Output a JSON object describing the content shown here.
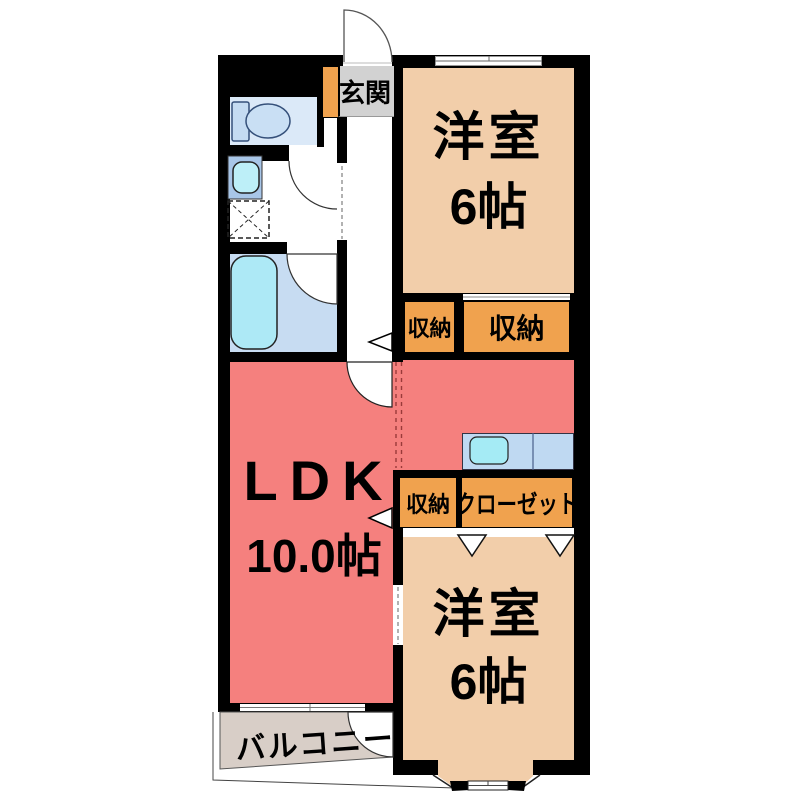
{
  "plan": {
    "entrance": {
      "label": "玄関"
    },
    "western_room_top": {
      "name": "洋室",
      "size": "6帖"
    },
    "western_room_bottom": {
      "name": "洋室",
      "size": "6帖"
    },
    "ldk": {
      "name": "LDK",
      "size": "10.0帖"
    },
    "storage_top_small": {
      "label": "収納"
    },
    "storage_top_large": {
      "label": "収納"
    },
    "storage_mid": {
      "label": "収納"
    },
    "closet": {
      "label": "クローゼット"
    },
    "balcony": {
      "label": "バルコニー"
    }
  },
  "colors": {
    "wall": "#000000",
    "western_room_peach": "#F2CEAA",
    "ldk_salmon": "#F5807E",
    "storage_orange": "#F0A24E",
    "entrance_gray": "#D2D2D2",
    "balcony_gray": "#D8CEC7",
    "bathroom_blue": "#C7DCF2",
    "toilet_room_blue": "#DBE9F8",
    "fixture_cyan": "#ADE9F6",
    "kitchen_counter_blue": "#BFD9F2"
  }
}
